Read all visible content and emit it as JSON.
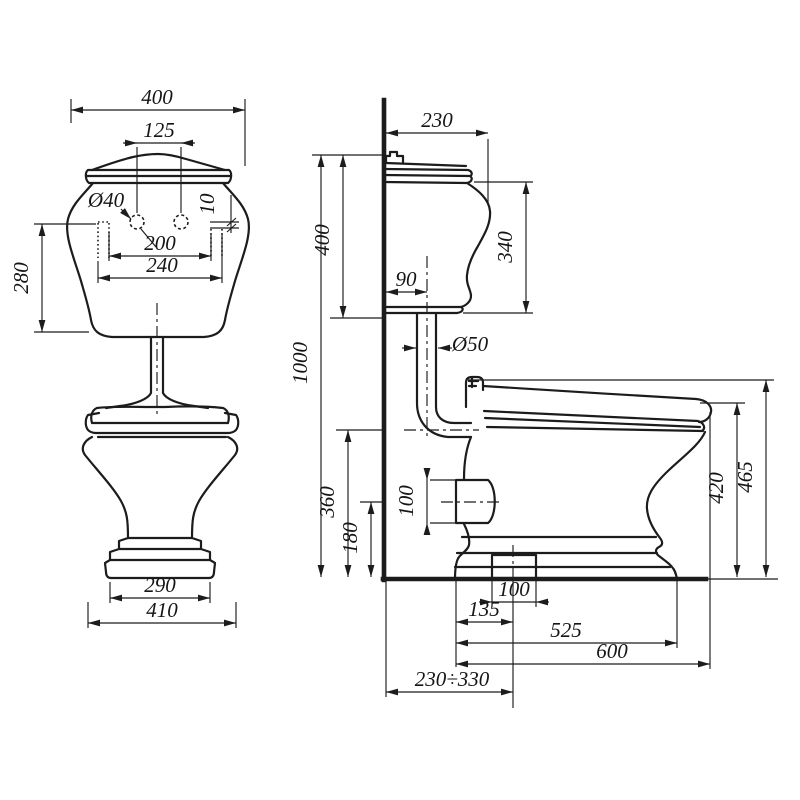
{
  "drawing": {
    "kind": "technical dimension drawing",
    "subject": "two-piece toilet (bowl with low-level cistern), front view and side view",
    "units": "mm",
    "line_color": "#1c1c1c",
    "background_color": "#ffffff"
  },
  "front_view": {
    "dims": {
      "tank_width": "400",
      "holes_spacing": "125",
      "hole_diameter": "Ø40",
      "hole_offset": "10",
      "fixing_inner": "200",
      "fixing_outer": "240",
      "tank_height": "280",
      "base_width": "290",
      "bowl_width": "410"
    }
  },
  "side_view": {
    "dims": {
      "tank_depth": "230",
      "tank_height": "400",
      "tank_body_height": "340",
      "pipe_offset": "90",
      "pipe_diameter": "Ø50",
      "total_height": "1000",
      "inlet_axis_height": "360",
      "outlet_axis_height": "180",
      "outlet_size": "100",
      "seat_height": "420",
      "rim_height": "465",
      "floor_hole_size": "100",
      "floor_hole_offset": "135",
      "base_depth": "525",
      "total_depth": "600",
      "outlet_offset_range": "230÷330"
    }
  }
}
